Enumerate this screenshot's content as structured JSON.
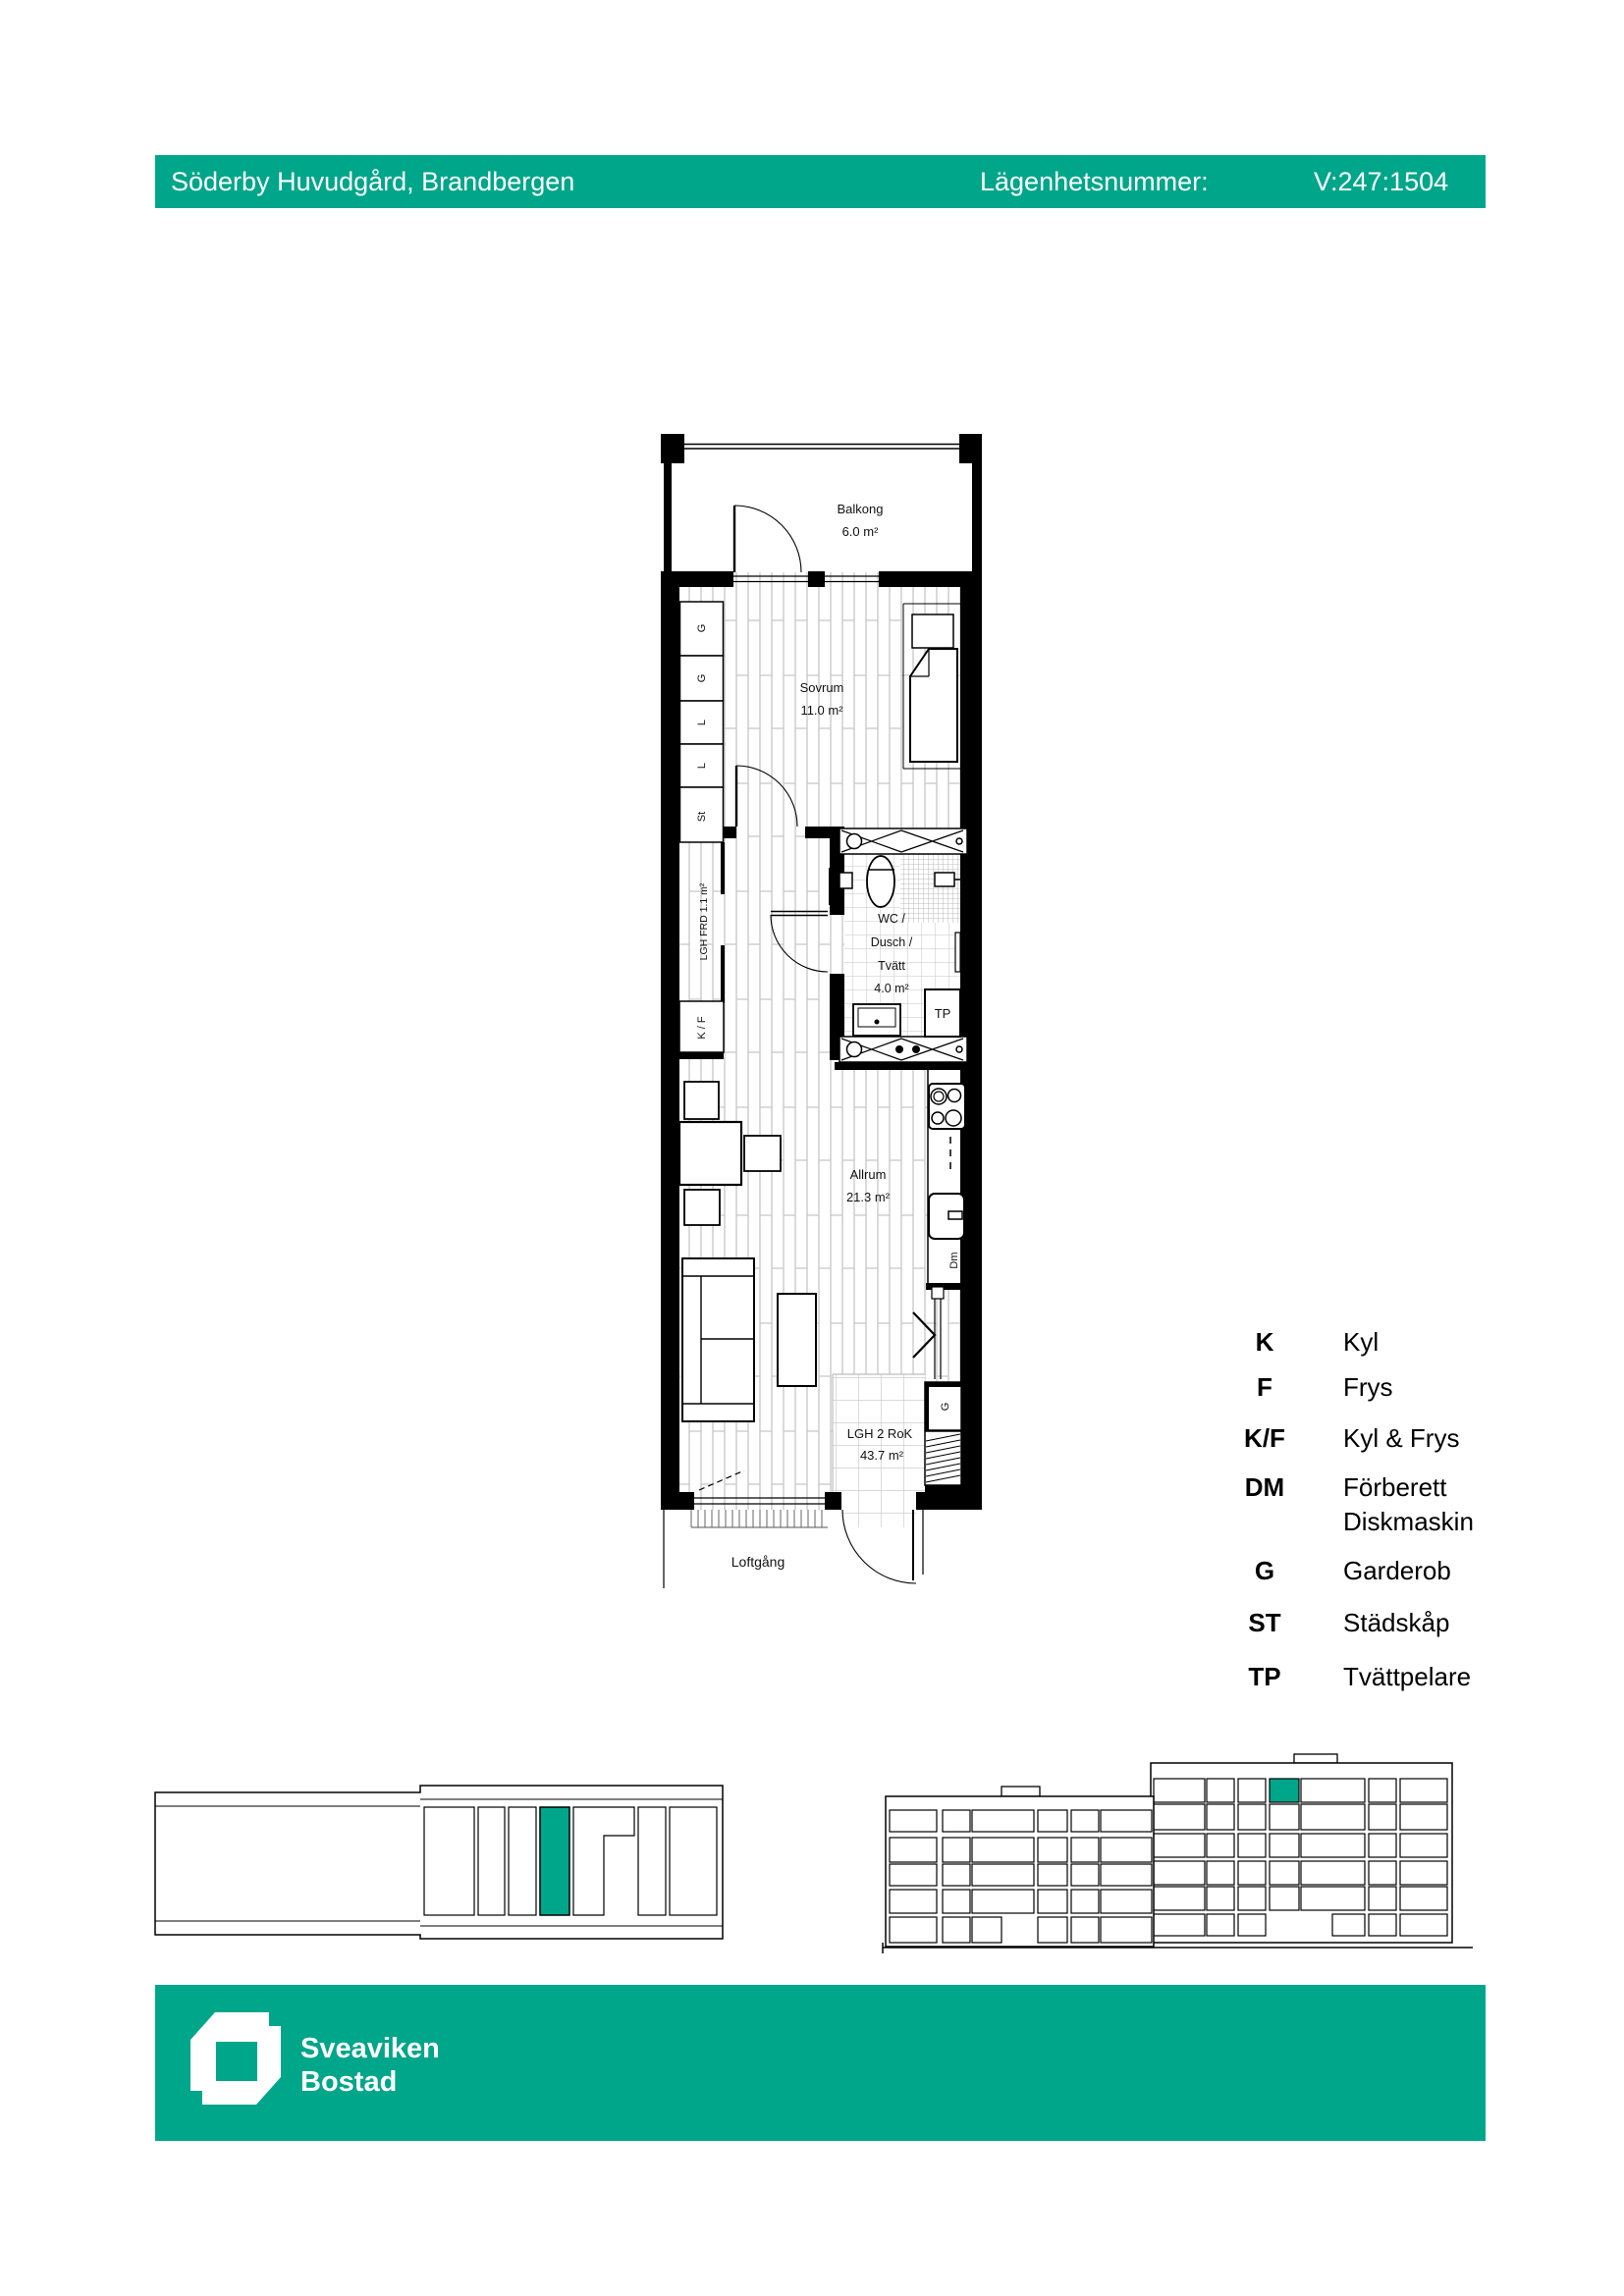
{
  "header": {
    "project": "Söderby Huvudgård, Brandbergen",
    "apartment_label": "Lägenhetsnummer:",
    "apartment_number": "V:247:1504"
  },
  "colors": {
    "accent": "#00a689"
  },
  "floorplan": {
    "balcony_name": "Balkong",
    "balcony_area": "6.0 m²",
    "bedroom_name": "Sovrum",
    "bedroom_area": "11.0 m²",
    "wc_line1": "WC /",
    "wc_line2": "Dusch /",
    "wc_line3": "Tvätt",
    "wc_area": "4.0 m²",
    "living_name": "Allrum",
    "living_area": "21.3 m²",
    "apartment_name": "LGH 2 RoK",
    "apartment_area": "43.7 m²",
    "walkway": "Loftgång",
    "storage": "LGH FRD 1.1 m²",
    "closets": [
      "G",
      "G",
      "L",
      "L",
      "St"
    ],
    "fridge_freezer": "K / F",
    "washer_tower": "TP",
    "dishwasher": "Dm",
    "entry_wardrobe": "G"
  },
  "legend": {
    "items": [
      {
        "abbr": "K",
        "desc": "Kyl"
      },
      {
        "abbr": "F",
        "desc": "Frys"
      },
      {
        "abbr": "K/F",
        "desc": "Kyl & Frys"
      },
      {
        "abbr": "DM",
        "desc": "Förberett",
        "desc2": "Diskmaskin"
      },
      {
        "abbr": "G",
        "desc": "Garderob"
      },
      {
        "abbr": "ST",
        "desc": "Städskåp"
      },
      {
        "abbr": "TP",
        "desc": "Tvättpelare"
      }
    ]
  },
  "footer": {
    "brand_line1": "Sveaviken",
    "brand_line2": "Bostad"
  }
}
